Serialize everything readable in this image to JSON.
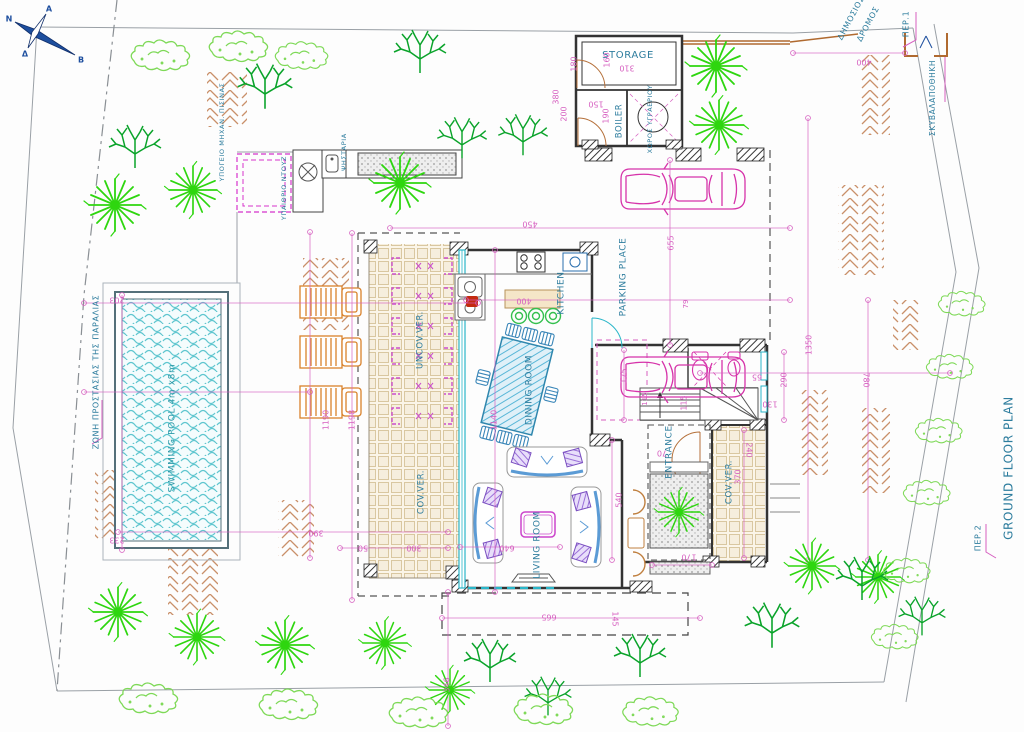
{
  "title": "GROUND FLOOR PLAN",
  "colors": {
    "dim_text": "#d65fc0",
    "label_text": "#2e7d9e",
    "wall": "#333333",
    "window": "#2ab6c9",
    "car": "#d633aa",
    "lounger": "#d9822b",
    "palm": "#2ed60f",
    "tree": "#0aa32a",
    "bush": "#7ed957",
    "ground_hatch": "#c9906a",
    "compass": "#1d4e9e"
  },
  "compass": {
    "letters": [
      "Ν",
      "Α",
      "Δ",
      "Β"
    ]
  },
  "labels": [
    {
      "id": "storage",
      "text": "STORAGE",
      "x": 628,
      "y": 55,
      "rot": 0,
      "size": 10
    },
    {
      "id": "boiler",
      "text": "BOILER",
      "x": 619,
      "y": 121,
      "rot": -90,
      "size": 8.5
    },
    {
      "id": "gas-room",
      "text": "ΧΩΡΟΣ ΥΓΡΑΕΡΙΟΥ",
      "x": 650,
      "y": 119,
      "rot": -90,
      "size": 6.5
    },
    {
      "id": "kitchen",
      "text": "KITCHEN",
      "x": 561,
      "y": 293,
      "rot": -90,
      "size": 9
    },
    {
      "id": "dining-room",
      "text": "DINING ROOM",
      "x": 529,
      "y": 390,
      "rot": -90,
      "size": 9
    },
    {
      "id": "living-room",
      "text": "LIVING ROOM",
      "x": 537,
      "y": 545,
      "rot": -90,
      "size": 9
    },
    {
      "id": "uncovered-veranda",
      "text": "UNCOV.VER.",
      "x": 420,
      "y": 340,
      "rot": -90,
      "size": 8.5
    },
    {
      "id": "covered-veranda-left",
      "text": "COV.VER.",
      "x": 421,
      "y": 492,
      "rot": -90,
      "size": 8.5
    },
    {
      "id": "covered-veranda-right",
      "text": "COV.VER.",
      "x": 729,
      "y": 482,
      "rot": -90,
      "size": 8.5
    },
    {
      "id": "entrance",
      "text": "ENTRANCE",
      "x": 669,
      "y": 452,
      "rot": -90,
      "size": 9
    },
    {
      "id": "parking-place",
      "text": "PARKING PLACE",
      "x": 623,
      "y": 277,
      "rot": -90,
      "size": 9
    },
    {
      "id": "swimming-pool",
      "text": "SWIMMING POOL 4m x8m",
      "x": 172,
      "y": 428,
      "rot": -90,
      "size": 9,
      "color": "#2e9aa8"
    },
    {
      "id": "beach-protection-zone",
      "text": "ΖΩΝΗ ΠΡΟΣΤΑΣΙΑΣ ΤΗΣ ΠΑΡΑΛΙΑΣ",
      "x": 96,
      "y": 372,
      "rot": -90,
      "size": 8
    },
    {
      "id": "plan-title",
      "text": "GROUND FLOOR PLAN",
      "x": 1009,
      "y": 468,
      "rot": -90,
      "size": 12
    },
    {
      "id": "per-1",
      "text": "ΠΕΡ.1",
      "x": 906,
      "y": 24,
      "rot": -90,
      "size": 8
    },
    {
      "id": "per-2",
      "text": "ΠΕΡ.2",
      "x": 978,
      "y": 538,
      "rot": -90,
      "size": 8
    },
    {
      "id": "garbage-store",
      "text": "ΣΚΥΒΑΛΑΠΟΘΗΚΗ",
      "x": 933,
      "y": 98,
      "rot": -90,
      "size": 7.5
    },
    {
      "id": "public-road-1",
      "text": "ΔΗΜΟΣΙΟΣ",
      "x": 851,
      "y": 18,
      "rot": -62,
      "size": 8
    },
    {
      "id": "public-road-2",
      "text": "ΔΡΟΜΟΣ",
      "x": 868,
      "y": 24,
      "rot": -62,
      "size": 8
    },
    {
      "id": "pool-machinery",
      "text": "ΥΠΟΓΕΙΟ ΜΗΧΑΝ. ΠΙΣΙΝΑΣ",
      "x": 222,
      "y": 132,
      "rot": -90,
      "size": 6.5
    },
    {
      "id": "outdoor-shower",
      "text": "ΥΠΑΙΘΡΙΟ ΝΤΟΥΖ",
      "x": 284,
      "y": 188,
      "rot": -90,
      "size": 6.5
    },
    {
      "id": "bbq",
      "text": "ΨΗΣΤΑΡΙΑ",
      "x": 344,
      "y": 152,
      "rot": -90,
      "size": 6.5
    }
  ],
  "dimensions": [
    {
      "text": "380",
      "x": 556,
      "y": 97,
      "rot": -90
    },
    {
      "text": "180",
      "x": 574,
      "y": 64,
      "rot": -90
    },
    {
      "text": "200",
      "x": 564,
      "y": 114,
      "rot": -90
    },
    {
      "text": "160",
      "x": 607,
      "y": 60,
      "rot": -90
    },
    {
      "text": "310",
      "x": 627,
      "y": 68,
      "rot": 180
    },
    {
      "text": "150",
      "x": 596,
      "y": 104,
      "rot": 180
    },
    {
      "text": "190",
      "x": 606,
      "y": 116,
      "rot": -90
    },
    {
      "text": "450",
      "x": 530,
      "y": 224,
      "rot": 180
    },
    {
      "text": "400",
      "x": 524,
      "y": 301,
      "rot": 180
    },
    {
      "text": "655",
      "x": 671,
      "y": 243,
      "rot": -90
    },
    {
      "text": "79",
      "x": 686,
      "y": 304,
      "rot": -90,
      "size": 7
    },
    {
      "text": "1350",
      "x": 809,
      "y": 345,
      "rot": -90
    },
    {
      "text": "780",
      "x": 866,
      "y": 380,
      "rot": 90
    },
    {
      "text": "290",
      "x": 784,
      "y": 380,
      "rot": -90
    },
    {
      "text": "130",
      "x": 770,
      "y": 404,
      "rot": 180
    },
    {
      "text": "65",
      "x": 757,
      "y": 377,
      "rot": 180
    },
    {
      "text": "175",
      "x": 624,
      "y": 376,
      "rot": -90
    },
    {
      "text": "115",
      "x": 684,
      "y": 403,
      "rot": -90
    },
    {
      "text": "115",
      "x": 645,
      "y": 399,
      "rot": -90,
      "size": 7
    },
    {
      "text": "1190",
      "x": 326,
      "y": 420,
      "rot": -90
    },
    {
      "text": "1198",
      "x": 352,
      "y": 420,
      "rot": -90
    },
    {
      "text": "1140",
      "x": 494,
      "y": 420,
      "rot": -90
    },
    {
      "text": "640",
      "x": 507,
      "y": 548,
      "rot": 180
    },
    {
      "text": "540",
      "x": 619,
      "y": 500,
      "rot": -90
    },
    {
      "text": "370",
      "x": 738,
      "y": 477,
      "rot": -90
    },
    {
      "text": "240",
      "x": 749,
      "y": 450,
      "rot": 90
    },
    {
      "text": "70",
      "x": 662,
      "y": 453,
      "rot": 180
    },
    {
      "text": "170",
      "x": 689,
      "y": 557,
      "rot": 180
    },
    {
      "text": "665",
      "x": 549,
      "y": 617,
      "rot": 180
    },
    {
      "text": "145",
      "x": 615,
      "y": 619,
      "rot": 90
    },
    {
      "text": "346",
      "x": 447,
      "y": 685,
      "rot": -90
    },
    {
      "text": "203",
      "x": 117,
      "y": 300,
      "rot": 180
    },
    {
      "text": "233",
      "x": 117,
      "y": 540,
      "rot": 180
    },
    {
      "text": "390",
      "x": 316,
      "y": 533,
      "rot": 180
    },
    {
      "text": "50",
      "x": 363,
      "y": 548,
      "rot": 180
    },
    {
      "text": "300",
      "x": 414,
      "y": 548,
      "rot": 180
    },
    {
      "text": "400",
      "x": 864,
      "y": 62,
      "rot": 180
    }
  ],
  "dimension_lines": [
    [
      84,
      303,
      478,
      303
    ],
    [
      84,
      392,
      310,
      392
    ],
    [
      122,
      295,
      122,
      550
    ],
    [
      310,
      232,
      310,
      558
    ],
    [
      352,
      233,
      352,
      600
    ],
    [
      118,
      532,
      448,
      532
    ],
    [
      340,
      548,
      448,
      548
    ],
    [
      448,
      592,
      448,
      726
    ],
    [
      442,
      618,
      700,
      618
    ],
    [
      495,
      250,
      495,
      592
    ],
    [
      390,
      228,
      790,
      228
    ],
    [
      670,
      160,
      670,
      345
    ],
    [
      466,
      300,
      790,
      300
    ],
    [
      808,
      118,
      808,
      560
    ],
    [
      868,
      300,
      868,
      560
    ],
    [
      784,
      352,
      784,
      420
    ],
    [
      700,
      373,
      950,
      373
    ],
    [
      624,
      350,
      624,
      420
    ],
    [
      793,
      53,
      905,
      53
    ],
    [
      460,
      547,
      560,
      547
    ],
    [
      612,
      440,
      612,
      560
    ],
    [
      744,
      430,
      744,
      558
    ],
    [
      652,
      565,
      712,
      565
    ]
  ],
  "ground_patches": [
    [
      860,
      55,
      30,
      80
    ],
    [
      838,
      185,
      46,
      90
    ],
    [
      800,
      390,
      28,
      85
    ],
    [
      862,
      408,
      28,
      85
    ],
    [
      95,
      470,
      40,
      70
    ],
    [
      168,
      545,
      50,
      70
    ],
    [
      303,
      258,
      46,
      72
    ],
    [
      278,
      500,
      36,
      57
    ],
    [
      893,
      300,
      26,
      50
    ],
    [
      207,
      72,
      40,
      55
    ]
  ],
  "trees": {
    "palm": [
      [
        115,
        205,
        1
      ],
      [
        193,
        190,
        0.92
      ],
      [
        400,
        183,
        1
      ],
      [
        716,
        66,
        1
      ],
      [
        719,
        125,
        0.95
      ],
      [
        118,
        612,
        0.95
      ],
      [
        197,
        637,
        0.9
      ],
      [
        285,
        645,
        0.95
      ],
      [
        385,
        643,
        0.85
      ],
      [
        450,
        690,
        0.8
      ],
      [
        812,
        566,
        0.9
      ],
      [
        878,
        577,
        0.85
      ],
      [
        679,
        512,
        0.8
      ]
    ],
    "deciduous": [
      [
        135,
        152,
        1
      ],
      [
        265,
        92,
        1.05
      ],
      [
        420,
        57,
        1
      ],
      [
        462,
        143,
        0.95
      ],
      [
        523,
        140,
        0.95
      ],
      [
        490,
        666,
        1
      ],
      [
        548,
        701,
        0.9
      ],
      [
        640,
        661,
        1
      ],
      [
        772,
        631,
        1.05
      ],
      [
        862,
        584,
        1
      ],
      [
        922,
        621,
        0.9
      ]
    ],
    "bush": [
      [
        162,
        57,
        1
      ],
      [
        240,
        48,
        1
      ],
      [
        303,
        57,
        0.9
      ],
      [
        150,
        700,
        1
      ],
      [
        290,
        706,
        1
      ],
      [
        420,
        714,
        1
      ],
      [
        545,
        711,
        1
      ],
      [
        652,
        713,
        0.95
      ],
      [
        963,
        305,
        0.8
      ],
      [
        951,
        368,
        0.8
      ],
      [
        940,
        432,
        0.8
      ],
      [
        928,
        494,
        0.8
      ],
      [
        908,
        572,
        0.8
      ],
      [
        896,
        638,
        0.8
      ]
    ]
  }
}
